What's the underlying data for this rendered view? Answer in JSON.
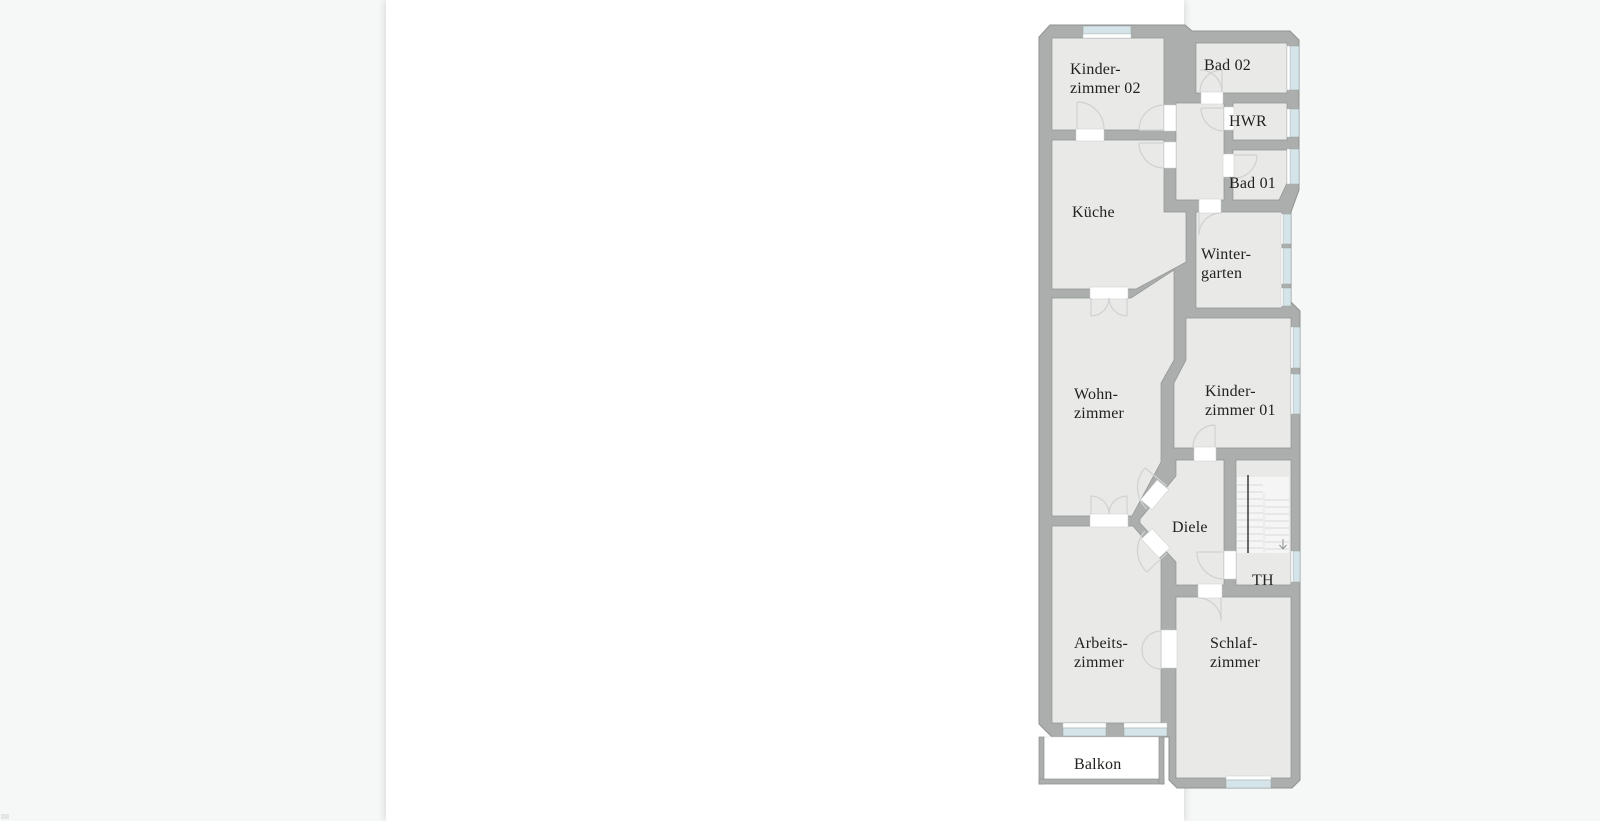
{
  "page": {
    "background": "#ffffff",
    "surround": "#f6f7f7"
  },
  "plan": {
    "labels": {
      "kinderzimmer02_line1": "Kinder-",
      "kinderzimmer02_line2": "zimmer 02",
      "bad02": "Bad 02",
      "hwr": "HWR",
      "bad01": "Bad 01",
      "kueche": "Küche",
      "wintergarten_line1": "Winter-",
      "wintergarten_line2": "garten",
      "wohnzimmer_line1": "Wohn-",
      "wohnzimmer_line2": "zimmer",
      "kinderzimmer01_line1": "Kinder-",
      "kinderzimmer01_line2": "zimmer 01",
      "diele": "Diele",
      "treppenhaus": "TH",
      "arbeitszimmer_line1": "Arbeits-",
      "arbeitszimmer_line2": "zimmer",
      "schlafzimmer_line1": "Schlaf-",
      "schlafzimmer_line2": "zimmer",
      "balkon": "Balkon"
    },
    "colors": {
      "wall": "#abaeac",
      "wall_outline": "#8f9391",
      "room_fill": "#e9eae8",
      "window_glass": "#d5e4e9",
      "door_arc": "#cfd2d0",
      "label_text": "#22211d",
      "stair_rail": "#454543",
      "page_bg": "#ffffff",
      "surround": "#f6f7f7"
    }
  }
}
